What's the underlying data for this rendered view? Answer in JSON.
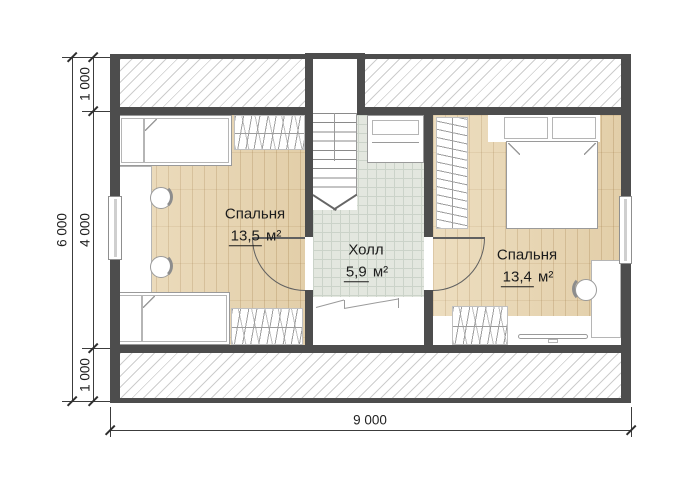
{
  "rooms": {
    "bedroom_left": {
      "name": "Спальня",
      "area_value": "13,5",
      "area_unit": "м²"
    },
    "hall": {
      "name": "Холл",
      "area_value": "5,9",
      "area_unit": "м²"
    },
    "bedroom_right": {
      "name": "Спальня",
      "area_value": "13,4",
      "area_unit": "м²"
    }
  },
  "dimensions": {
    "vertical_total": "6 000",
    "vertical_segment_top": "1 000",
    "vertical_segment_middle": "4 000",
    "vertical_segment_bottom": "1 000",
    "horizontal_total": "9 000"
  },
  "colors": {
    "wall": "#4d4d4d",
    "wood_floor": "#e9d6b1",
    "tile_floor": "#e3e7df",
    "hatch_line": "#cdcdcd"
  }
}
